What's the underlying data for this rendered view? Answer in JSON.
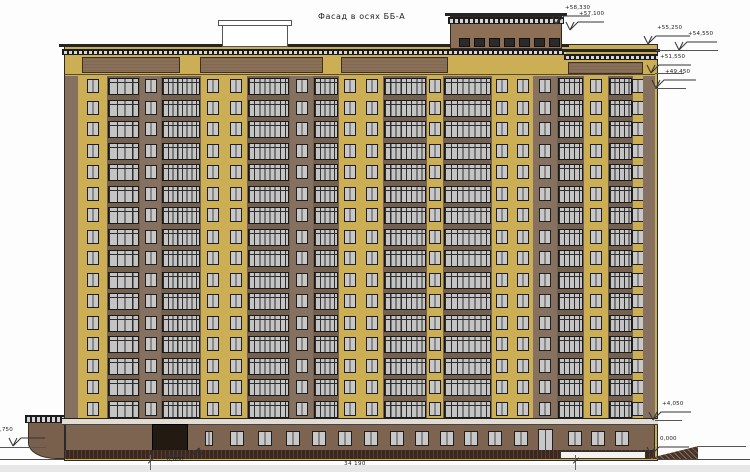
{
  "title": "Фасад в осях ББ-А",
  "dimension": {
    "label": "34 190",
    "x1": 150,
    "x2": 575,
    "y": 460
  },
  "colors": {
    "yellow": "#ccae55",
    "brown": "#86705f",
    "spandrel": "#73604f",
    "penthouse": "#8d6f55",
    "ground": "#7d6450",
    "podium": "#78604c",
    "plinth": "#3c2820",
    "glass": "#c6c6c6",
    "frame": "#1f1f1f",
    "line": "#333333",
    "entrance": "#231a11",
    "cornice_light": "#e2dcd2"
  },
  "building": {
    "x": 65,
    "w": 590,
    "facade_top": 76,
    "facade_h": 344,
    "floors": 16
  },
  "bays": [
    {
      "t": "pier",
      "w": 13,
      "bg": "brown"
    },
    {
      "t": "w1",
      "w": 29,
      "bg": "yellow"
    },
    {
      "t": "bal",
      "w": 33,
      "p": 4
    },
    {
      "t": "w1",
      "w": 21,
      "bg": "brown"
    },
    {
      "t": "bal",
      "w": 40,
      "p": 8
    },
    {
      "t": "w2",
      "w": 46,
      "bg": "yellow"
    },
    {
      "t": "bal",
      "w": 43,
      "p": 8
    },
    {
      "t": "w1",
      "w": 23,
      "bg": "brown"
    },
    {
      "t": "bal",
      "w": 26,
      "p": 5
    },
    {
      "t": "w2",
      "w": 44,
      "bg": "yellow"
    },
    {
      "t": "bal",
      "w": 44,
      "p": 8
    },
    {
      "t": "w1",
      "w": 16,
      "bg": "yellow"
    },
    {
      "t": "bal",
      "w": 49,
      "p": 8
    },
    {
      "t": "w2",
      "w": 41,
      "bg": "yellow"
    },
    {
      "t": "w1",
      "w": 24,
      "bg": "brown"
    },
    {
      "t": "bal",
      "w": 27,
      "p": 5
    },
    {
      "t": "w1",
      "w": 24,
      "bg": "yellow"
    },
    {
      "t": "bal",
      "w": 25,
      "p": 5
    },
    {
      "t": "w1",
      "w": 10,
      "bg": "yellow"
    },
    {
      "t": "pier",
      "w": 12,
      "bg": "brown"
    }
  ],
  "attic": {
    "panels_main": [
      [
        17,
        115
      ],
      [
        135,
        258
      ],
      [
        276,
        383
      ]
    ],
    "panels_right": [
      [
        503,
        578
      ]
    ]
  },
  "penthouse": {
    "x": 450,
    "y": 13,
    "w": 112,
    "windows": 7
  },
  "vent": {
    "x": 222,
    "y": 20,
    "w": 68
  },
  "podium": {
    "x": 28,
    "w": 122,
    "top": 415
  },
  "ground_floor": {
    "top": 418,
    "narrow_x": 205,
    "entrance_x": 152,
    "door_x": 538,
    "window_xs": [
      230,
      258,
      286,
      312,
      338,
      364,
      390,
      415,
      440,
      464,
      488,
      514,
      568,
      591,
      615
    ]
  },
  "marks": [
    {
      "label": "+58,330",
      "tx": 556,
      "ty": 24,
      "dir": "down",
      "len": 26
    },
    {
      "label": "+57,100",
      "tx": 570,
      "ty": 30,
      "dir": "down",
      "len": 26
    },
    {
      "label": "+55,250",
      "tx": 648,
      "ty": 44,
      "dir": "down",
      "len": 34
    },
    {
      "label": "+54,550",
      "tx": 679,
      "ty": 50,
      "dir": "down",
      "len": 30
    },
    {
      "label": "+51,550",
      "tx": 651,
      "ty": 73,
      "dir": "down",
      "len": 32
    },
    {
      "label": "+49,450",
      "tx": 656,
      "ty": 88,
      "dir": "down",
      "len": 32
    },
    {
      "label": "+4,050",
      "tx": 653,
      "ty": 420,
      "dir": "down",
      "len": 30
    },
    {
      "label": "0,000",
      "tx": 651,
      "ty": 455,
      "dir": "down",
      "len": 30
    },
    {
      "label": "-0,750",
      "tx": 13,
      "ty": 446,
      "dir": "down",
      "len": 24,
      "lx": -14
    },
    {
      "label": "0,000",
      "tx": 199,
      "ty": 448,
      "dir": "up"
    }
  ],
  "leaders": [
    {
      "x1": 656,
      "x2": 718,
      "y": 50
    },
    {
      "x1": 655,
      "x2": 684,
      "y": 73
    },
    {
      "x1": 655,
      "x2": 686,
      "y": 88
    },
    {
      "x1": 655,
      "x2": 682,
      "y": 420
    },
    {
      "x1": 0,
      "x2": 46,
      "y": 447
    },
    {
      "x1": 698,
      "x2": 746,
      "y": 446
    }
  ]
}
